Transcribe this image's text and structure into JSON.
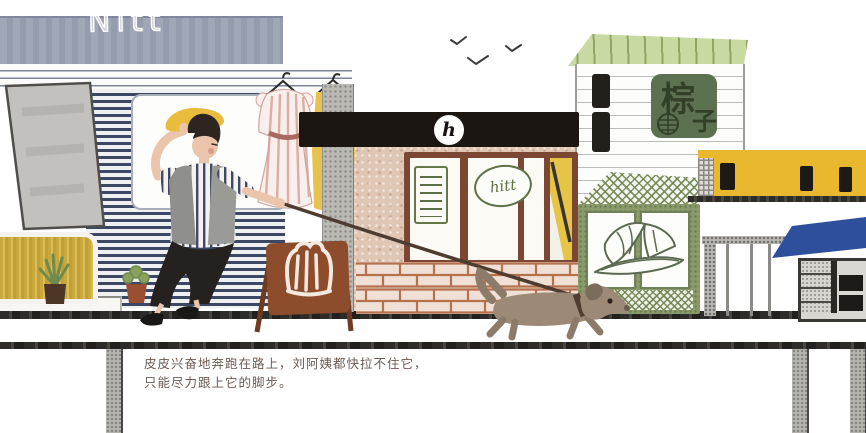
{
  "caption": {
    "line1": "皮皮兴奋地奔跑在路上，刘阿姨都快拉不住它，",
    "line2": "只能尽力跟上它的脚步。"
  },
  "left_shop": {
    "sign_text": "Nitt",
    "sign_color": "#99a1b2",
    "shutter_stripe_color": "#3c4763"
  },
  "cafe": {
    "logo_letter": "h",
    "window_sign_text": "hitt",
    "awning_color": "#1b1612",
    "window_frame_color": "#7b4733",
    "sandwich_board_color": "#8d4c2c"
  },
  "zongzi_shop": {
    "sign_char_top": "棕",
    "sign_char_bottom": "子",
    "sign_color": "#5c7150",
    "roof_color": "#c9d9a2"
  },
  "yellow_building": {
    "color": "#e9b82e"
  },
  "street_stall": {
    "awning_color": "#2e4f9c"
  },
  "figures": {
    "woman": "woman in yellow hat holding dog leash",
    "dog": "brown dachshund running right",
    "birds": "three birds in sky"
  }
}
